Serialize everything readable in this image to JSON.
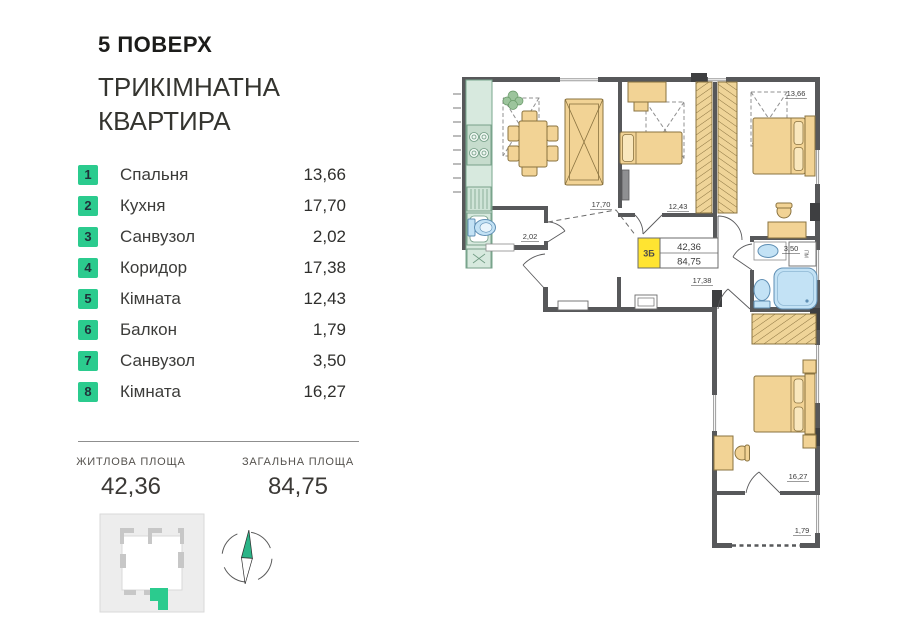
{
  "header": {
    "floor": "5 ПОВЕРХ",
    "type_line1": "ТРИКІМНАТНА",
    "type_line2": "КВАРТИРА"
  },
  "legend": {
    "items": [
      {
        "num": "1",
        "label": "Спальня",
        "area": "13,66"
      },
      {
        "num": "2",
        "label": "Кухня",
        "area": "17,70"
      },
      {
        "num": "3",
        "label": "Санвузол",
        "area": "2,02"
      },
      {
        "num": "4",
        "label": "Коридор",
        "area": "17,38"
      },
      {
        "num": "5",
        "label": "Кімната",
        "area": "12,43"
      },
      {
        "num": "6",
        "label": "Балкон",
        "area": "1,79"
      },
      {
        "num": "7",
        "label": "Санвузол",
        "area": "3,50"
      },
      {
        "num": "8",
        "label": "Кімната",
        "area": "16,27"
      }
    ]
  },
  "summary": {
    "living_label": "ЖИТЛОВА ПЛОЩА",
    "living_value": "42,36",
    "total_label": "ЗАГАЛЬНА ПЛОЩА",
    "total_value": "84,75"
  },
  "plan": {
    "badge": {
      "code": "3Б",
      "living": "42,36",
      "total": "84,75"
    },
    "labels": {
      "bedroom": "13,66",
      "kitchen": "17,70",
      "room_mid": "12,43",
      "bath_small": "2,02",
      "hall": "17,38",
      "bath_big": "3,50",
      "room_lower": "16,27",
      "balcony": "1,79"
    },
    "washer_label": "ПМ"
  },
  "colors": {
    "accent_green": "#2bcb8e",
    "wall_gray": "#57585a",
    "furniture_tan": "#f2d395",
    "water_blue": "#c3e2f5",
    "badge_yellow": "#ffe431"
  }
}
